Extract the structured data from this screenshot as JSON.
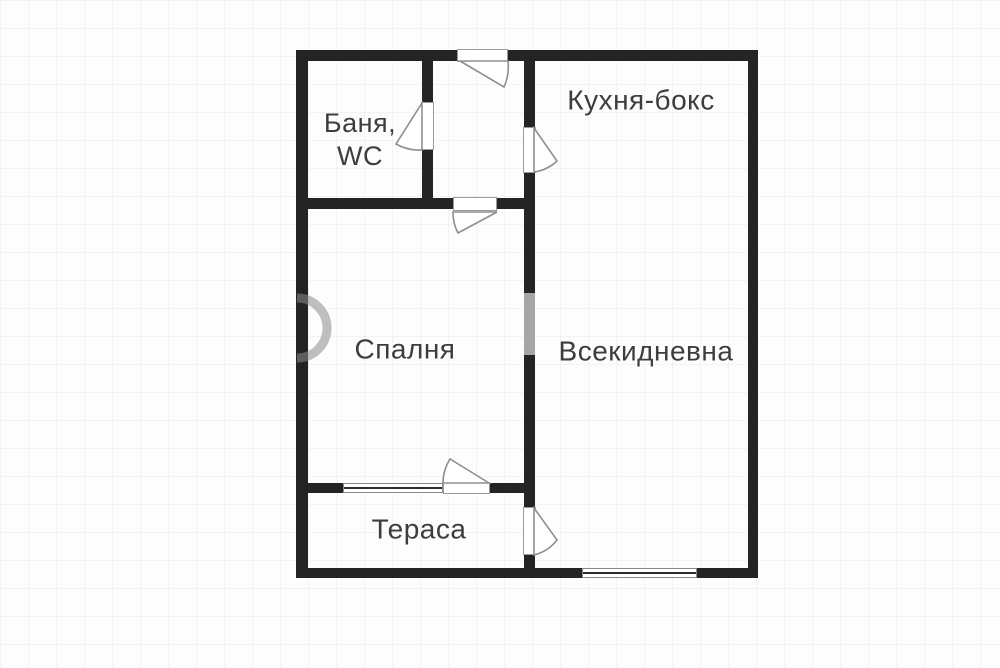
{
  "floorplan": {
    "type": "apartment-floor-plan",
    "language": "Bulgarian",
    "rooms": [
      {
        "name": "bathroom",
        "label_line1": "Баня,",
        "label_line2": "WC"
      },
      {
        "name": "kitchen",
        "label": "Кухня-бокс"
      },
      {
        "name": "bedroom",
        "label": "Спалня"
      },
      {
        "name": "living_room",
        "label": "Всекидневна"
      },
      {
        "name": "terrace",
        "label": "Тераса"
      }
    ],
    "colors": {
      "wall": "#242424",
      "label_text": "#3d3d3d",
      "door_frame": "#9a9a9a",
      "window_line": "#2e2e2e",
      "watermark": "#8c8c8c",
      "background": "#fdfdfd"
    },
    "features": {
      "door_count": 6,
      "window_count": 2
    }
  }
}
